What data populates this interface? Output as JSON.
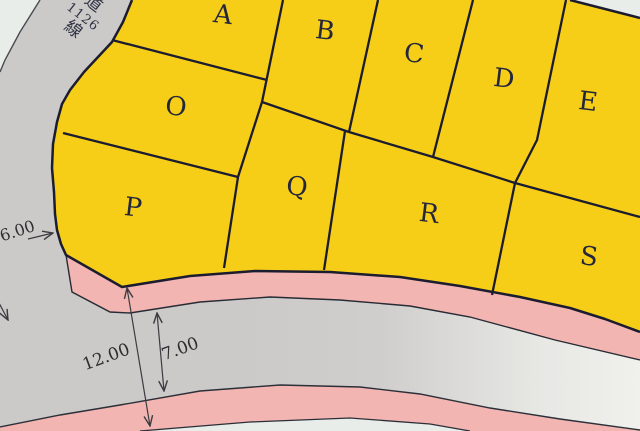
{
  "map": {
    "road_label": {
      "prefix_kanji": "道",
      "number": "1126",
      "suffix_kanji": "線"
    },
    "lots": [
      {
        "label": "A"
      },
      {
        "label": "B"
      },
      {
        "label": "C"
      },
      {
        "label": "D"
      },
      {
        "label": "E"
      },
      {
        "label": "O"
      },
      {
        "label": "P"
      },
      {
        "label": "Q"
      },
      {
        "label": "R"
      },
      {
        "label": "S"
      }
    ],
    "dimensions": {
      "total_road_width": "12.00",
      "carriageway_width": "7.00",
      "side_road_width": "6.00"
    },
    "colors": {
      "lot_fill": "#F6CE18",
      "sidewalk_pink": "#F2B5B2",
      "road_gray": "#CBCAC9",
      "road_gray_light": "#F0F0ED",
      "background": "#E8EDE9",
      "boundary_line": "#1C1C30",
      "dimension_line": "#3b3b40"
    }
  }
}
